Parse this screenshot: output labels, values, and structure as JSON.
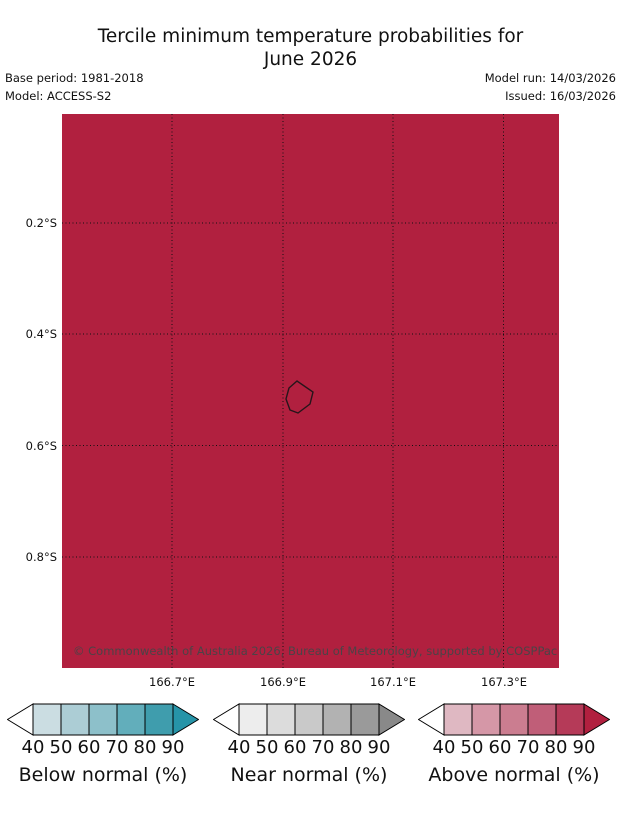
{
  "title": {
    "line1": "Tercile minimum temperature probabilities for",
    "line2": "June 2026"
  },
  "meta": {
    "base_period": "Base period: 1981-2018",
    "model": "Model: ACCESS-S2",
    "model_run": "Model run: 14/03/2026",
    "issued": "Issued: 16/03/2026"
  },
  "map": {
    "fill_color": "#b1203f",
    "outline_color": "#26151a",
    "copyright_color": "#4b4347",
    "copyright": "© Commonwealth of Australia 2026, Bureau of Meteorology, supported by COSPPac",
    "x_tick_labels": [
      "166.7°E",
      "166.9°E",
      "167.1°E",
      "167.3°E"
    ],
    "y_tick_labels": [
      "0.2°S",
      "0.4°S",
      "0.6°S",
      "0.8°S"
    ]
  },
  "legend": {
    "left_arrow_fill": "#ffffff",
    "tick_labels": [
      "40",
      "50",
      "60",
      "70",
      "80",
      "90"
    ],
    "bars": [
      {
        "label": "Below normal (%)",
        "segment_colors": [
          "#cbdde2",
          "#accdd5",
          "#8dc0ca",
          "#62aebb",
          "#3f9dad"
        ],
        "arrow_color": "#2694a8"
      },
      {
        "label": "Near normal (%)",
        "segment_colors": [
          "#ededed",
          "#dcdcdc",
          "#c9c9c9",
          "#b2b2b2",
          "#9a9a9a"
        ],
        "arrow_color": "#898989"
      },
      {
        "label": "Above normal (%)",
        "segment_colors": [
          "#dfb8c2",
          "#d597a7",
          "#cb7d90",
          "#c05e78",
          "#b53a58"
        ],
        "arrow_color": "#b1203f"
      }
    ]
  },
  "chart_data": {
    "type": "map",
    "title": "Tercile minimum temperature probabilities for June 2026",
    "x_ticks": [
      "166.7°E",
      "166.9°E",
      "167.1°E",
      "167.3°E"
    ],
    "y_ticks": [
      "0.2°S",
      "0.4°S",
      "0.6°S",
      "0.8°S"
    ],
    "grid": true,
    "uniform_fill": true,
    "dominant_category": "Above normal",
    "dominant_probability": ">90%",
    "legend_position": "bottom",
    "legend_bars": [
      {
        "name": "Below normal (%)",
        "ticks": [
          40,
          50,
          60,
          70,
          80,
          90
        ]
      },
      {
        "name": "Near normal (%)",
        "ticks": [
          40,
          50,
          60,
          70,
          80,
          90
        ]
      },
      {
        "name": "Above normal (%)",
        "ticks": [
          40,
          50,
          60,
          70,
          80,
          90
        ]
      }
    ]
  }
}
